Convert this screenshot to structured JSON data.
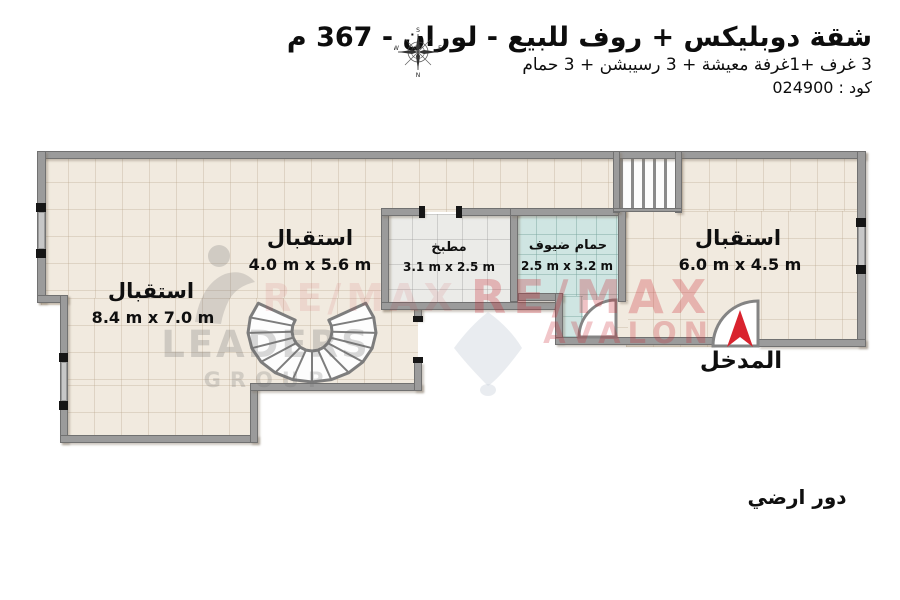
{
  "header": {
    "title": "شقة دوبليكس + روف للبيع - لوران - 367 م",
    "subtitle": "3 غرف +1غرفة معيشة + 3 رسيبشن + 3 حمام",
    "code_line": "كود : 024900",
    "compass": {
      "top_letter": "S",
      "bottom_letter": "N",
      "left_letter": "W",
      "right_letter": "E"
    }
  },
  "plan": {
    "rooms": [
      {
        "name": "استقبال",
        "dims": "4.0 m x 5.6 m"
      },
      {
        "name": "استقبال",
        "dims": "8.4 m x 7.0 m"
      },
      {
        "name": "مطبخ",
        "dims": "3.1 m x 2.5 m"
      },
      {
        "name": "حمام ضيوف",
        "dims": "2.5 m x 3.2 m"
      },
      {
        "name": "استقبال",
        "dims": "6.0 m x 4.5 m"
      }
    ],
    "entrance_label": "المدخل",
    "floor_label": "دور ارضي"
  },
  "watermarks": {
    "agency_main": "RE/MAX",
    "agency_sub": "AVALON",
    "group_main": "LEADERS",
    "group_sub": "GROUP"
  },
  "colors": {
    "floor_tile": "#f1eadf",
    "kitchen_tile": "#ebebe8",
    "bath_tile": "#cfe5e2",
    "wall": "#9b9b9b",
    "entrance_arrow": "#d9232e",
    "watermark_red": "#c8232d",
    "text": "#111111"
  }
}
